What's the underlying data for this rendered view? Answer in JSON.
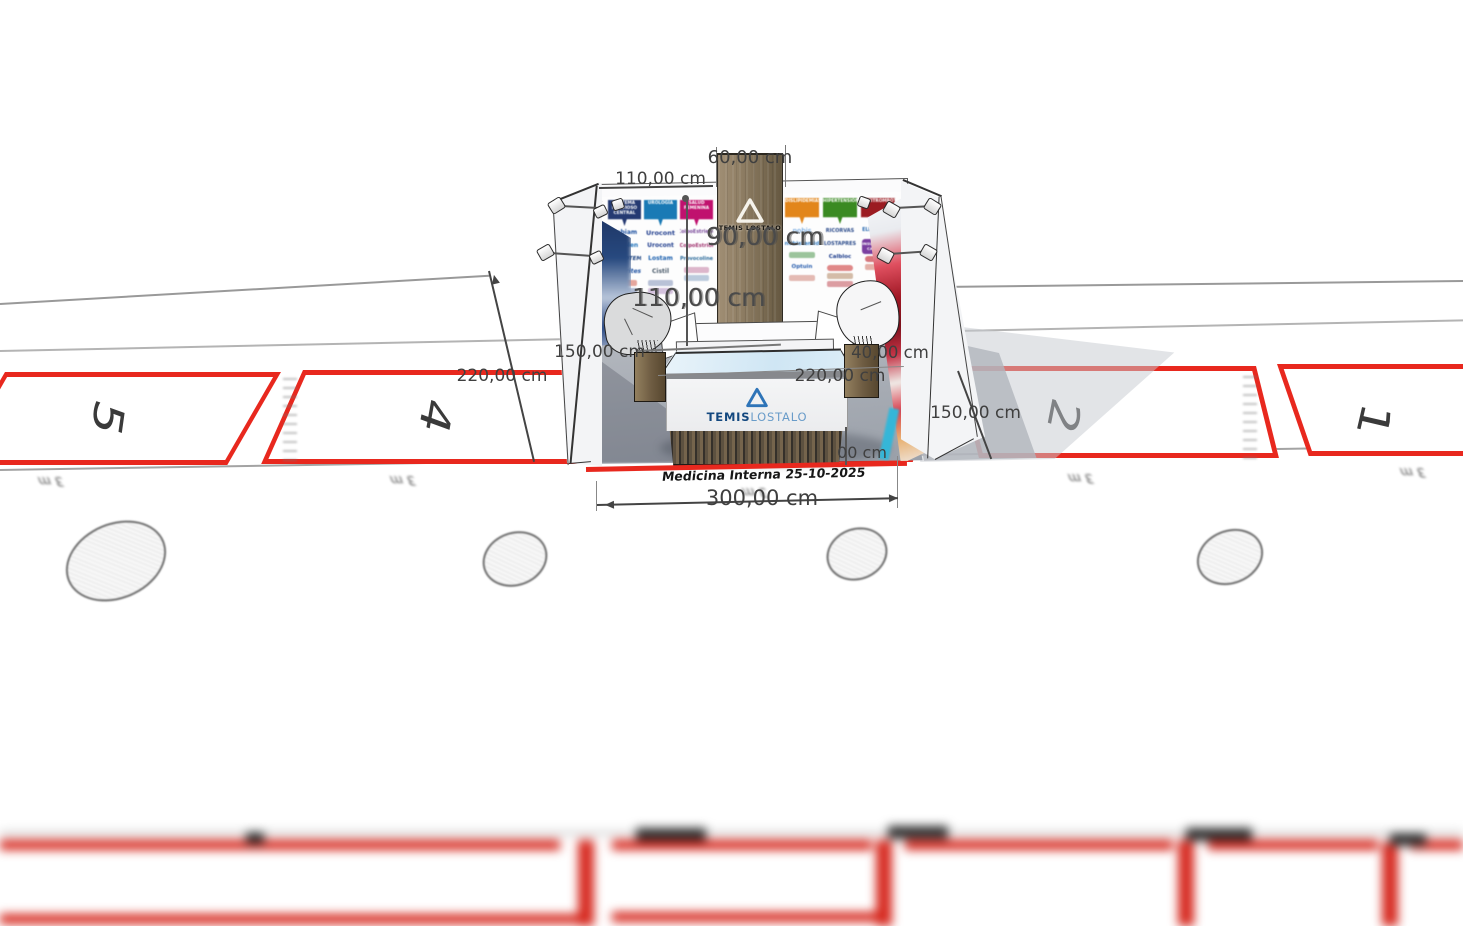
{
  "scene": {
    "background": "#ffffff",
    "space_outline_color": "#e8281e",
    "event_label": "Medicina Interna 25-10-2025",
    "space_numbers": [
      "5",
      "4",
      "2",
      "1"
    ],
    "tick_label": "3 m"
  },
  "dimensions": {
    "column_width": "60,00 cm",
    "top_left": "110,00 cm",
    "column_depth": "90,00 cm",
    "mid": "110,00 cm",
    "left_wall": "150,00 cm",
    "height_left": "220,00 cm",
    "right_small": "40,00 cm",
    "counter": "220,00 cm",
    "right_floor": "150,00 cm",
    "partial": "00 cm",
    "booth_width": "300,00 cm"
  },
  "booth": {
    "column_logo": "TEMIS LOSTALO",
    "counter_logo": {
      "temis": "TEMIS",
      "lostalo": "LOSTALO"
    },
    "accent_blue": "#2e74b8",
    "left_wall": {
      "headers": [
        {
          "label": "SISTEMA NERVIOSO CENTRAL",
          "color": "#253a72"
        },
        {
          "label": "UROLOGÍA",
          "color": "#1a7ab5"
        },
        {
          "label": "SALUD FEMENINA",
          "color": "#c0116e"
        }
      ],
      "brands": [
        [
          "Kabiam",
          "Beaplen",
          "NEUROTEM",
          "Dendrites"
        ],
        [
          "Urocont",
          "Urocont",
          "Lostam",
          "Cistil"
        ],
        [
          "ColpoEstriene",
          "ColpoEstriol",
          "Provocoline"
        ]
      ]
    },
    "right_wall": {
      "headers": [
        {
          "label": "DISLIPIDEMIAS",
          "color": "#e2861b"
        },
        {
          "label": "HIPERTENSIÓN",
          "color": "#3a8a22"
        },
        {
          "label": "ANTITROMBÓTICO",
          "color": "#9b1b21"
        }
      ],
      "brands": [
        [
          "nobis",
          "nobistamid",
          "Optuin"
        ],
        [
          "RICORVAS",
          "LOSTAPRES",
          "Calbloc"
        ],
        [
          "ELEVATERIS"
        ]
      ],
      "badge": {
        "label": "INSUFICIENCIA CARDÍACA",
        "color": "#7a3fa0"
      }
    }
  }
}
